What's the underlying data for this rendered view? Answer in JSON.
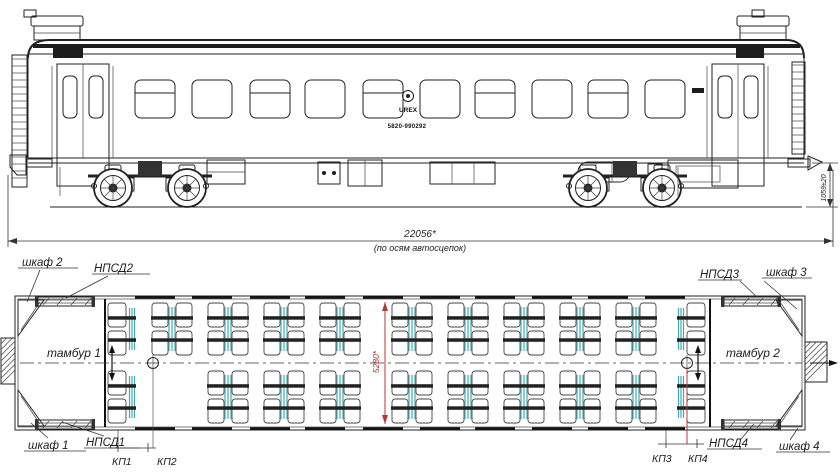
{
  "drawing_colors": {
    "line": "#222222",
    "table_teal": "#46a9ac",
    "dim_red": "#b03a3a"
  },
  "elevation": {
    "logo_text": "UREX",
    "car_number": "5820-990292",
    "length_dim": "22056*",
    "length_note": "(по осям автосцепок)",
    "coupler_height_dim": "1059±20",
    "windows": [
      {
        "x": 135,
        "split": true
      },
      {
        "x": 192,
        "split": false
      },
      {
        "x": 250,
        "split": true
      },
      {
        "x": 305,
        "split": false
      },
      {
        "x": 363,
        "split": true
      },
      {
        "x": 420,
        "split": false
      },
      {
        "x": 475,
        "split": true
      },
      {
        "x": 532,
        "split": false
      },
      {
        "x": 588,
        "split": true
      },
      {
        "x": 645,
        "split": false
      }
    ]
  },
  "plan": {
    "width_dim": "5280*",
    "labels": {
      "cabinet1": "шкаф 1",
      "cabinet2": "шкаф 2",
      "cabinet3": "шкаф 3",
      "cabinet4": "шкаф 4",
      "npsd1": "НПСД1",
      "npsd2": "НПСД2",
      "npsd3": "НПСД3",
      "npsd4": "НПСД4",
      "vestibule1": "тамбур 1",
      "vestibule2": "тамбур 2",
      "kp1": "КП1",
      "kp2": "КП2",
      "kp3": "КП3",
      "kp4": "КП4"
    },
    "seats": {
      "bay_width": 44,
      "bay_height": 54,
      "top_row_y": 302,
      "bottom_row_y": 370,
      "top_x": [
        150,
        206,
        262,
        318,
        390,
        446,
        502,
        558,
        614
      ],
      "bottom_x": [
        206,
        262,
        318,
        390,
        446,
        502,
        558,
        614
      ],
      "half_left_x": 107,
      "half_right_x": 676,
      "half_width": 30
    },
    "door_pockets": [
      {
        "x": 38,
        "y": 297
      },
      {
        "x": 38,
        "y": 420
      },
      {
        "x": 724,
        "y": 297
      },
      {
        "x": 724,
        "y": 420
      }
    ]
  }
}
